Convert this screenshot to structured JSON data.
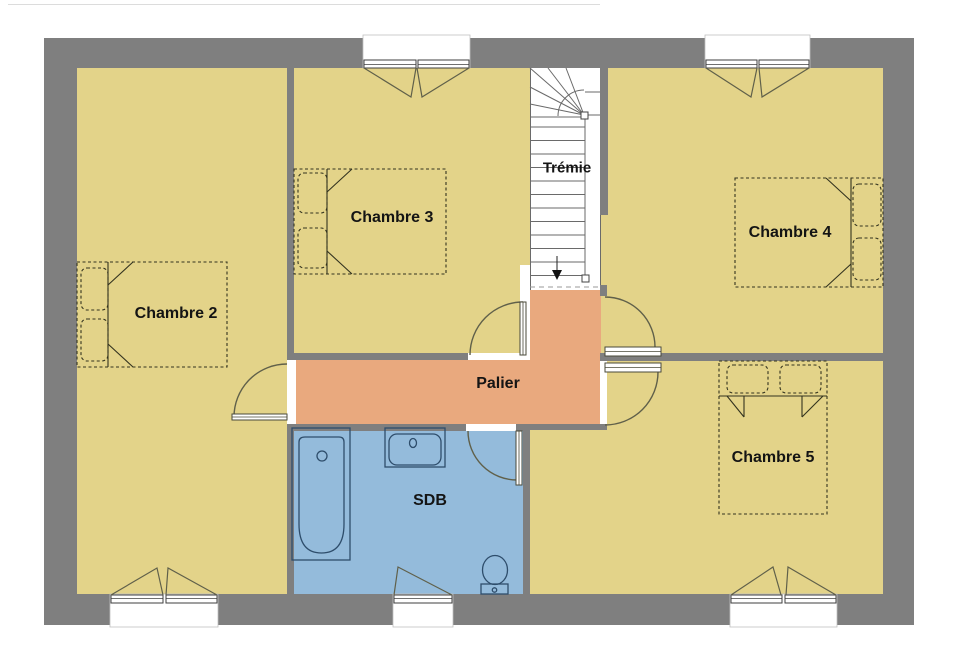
{
  "floor_plan": {
    "rooms": [
      {
        "id": "chambre-2",
        "label": "Chambre 2"
      },
      {
        "id": "chambre-3",
        "label": "Chambre 3"
      },
      {
        "id": "chambre-4",
        "label": "Chambre 4"
      },
      {
        "id": "chambre-5",
        "label": "Chambre 5"
      },
      {
        "id": "palier",
        "label": "Palier"
      },
      {
        "id": "sdb",
        "label": "SDB"
      },
      {
        "id": "tremie",
        "label": "Trémie"
      }
    ],
    "colors": {
      "wall": "#7f7f7f",
      "bedroom_floor": "#e3d389",
      "hallway_floor": "#e9a97e",
      "bathroom_floor": "#94bbdb",
      "stairwell": "#ffffff",
      "label_text": "#141414"
    },
    "symbols": [
      "bed",
      "pillow",
      "door-swing",
      "window",
      "stairs",
      "bathtub",
      "sink",
      "toilet"
    ]
  }
}
